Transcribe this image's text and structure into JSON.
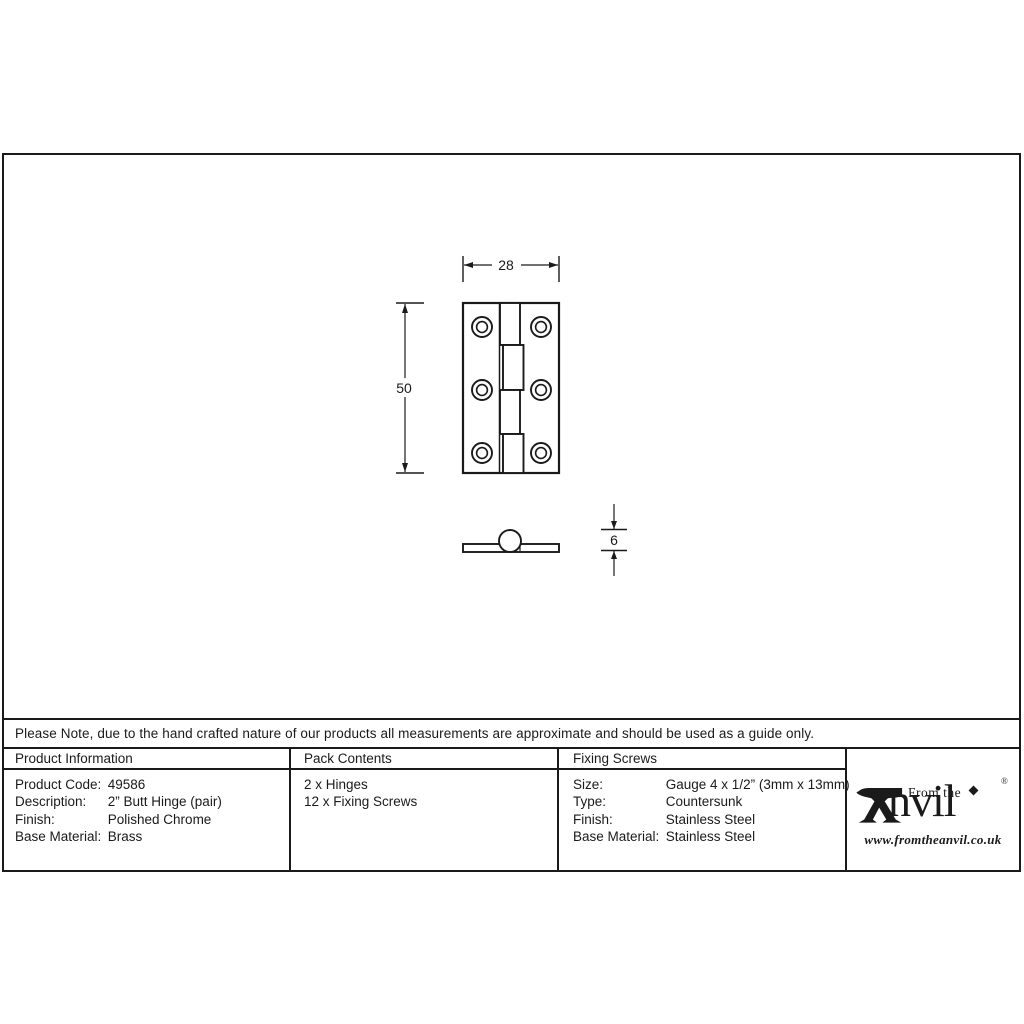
{
  "colors": {
    "ink": "#1a1a1a",
    "paper": "#ffffff"
  },
  "note": {
    "text": "Please Note, due to the hand crafted nature of our products all measurements are approximate and should be used as a guide only."
  },
  "drawing": {
    "dim_width": "28",
    "dim_height": "50",
    "dim_thickness": "6"
  },
  "table": {
    "product_information": {
      "header": "Product Information",
      "rows": [
        {
          "label": "Product Code:",
          "value": "49586"
        },
        {
          "label": "Description:",
          "value": "2” Butt Hinge (pair)"
        },
        {
          "label": "Finish:",
          "value": "Polished Chrome"
        },
        {
          "label": "Base Material:",
          "value": "Brass"
        }
      ]
    },
    "pack_contents": {
      "header": "Pack Contents",
      "items": [
        "2 x Hinges",
        "12 x Fixing Screws"
      ]
    },
    "fixing_screws": {
      "header": "Fixing Screws",
      "rows": [
        {
          "label": "Size:",
          "value": "Gauge 4 x 1/2” (3mm x 13mm)"
        },
        {
          "label": "Type:",
          "value": "Countersunk"
        },
        {
          "label": "Finish:",
          "value": "Stainless Steel"
        },
        {
          "label": "Base Material:",
          "value": "Stainless Steel"
        }
      ]
    },
    "logo": {
      "tagline": "From the",
      "brand": "nvil",
      "registered": "®",
      "website": "www.fromtheanvil.co.uk"
    }
  }
}
